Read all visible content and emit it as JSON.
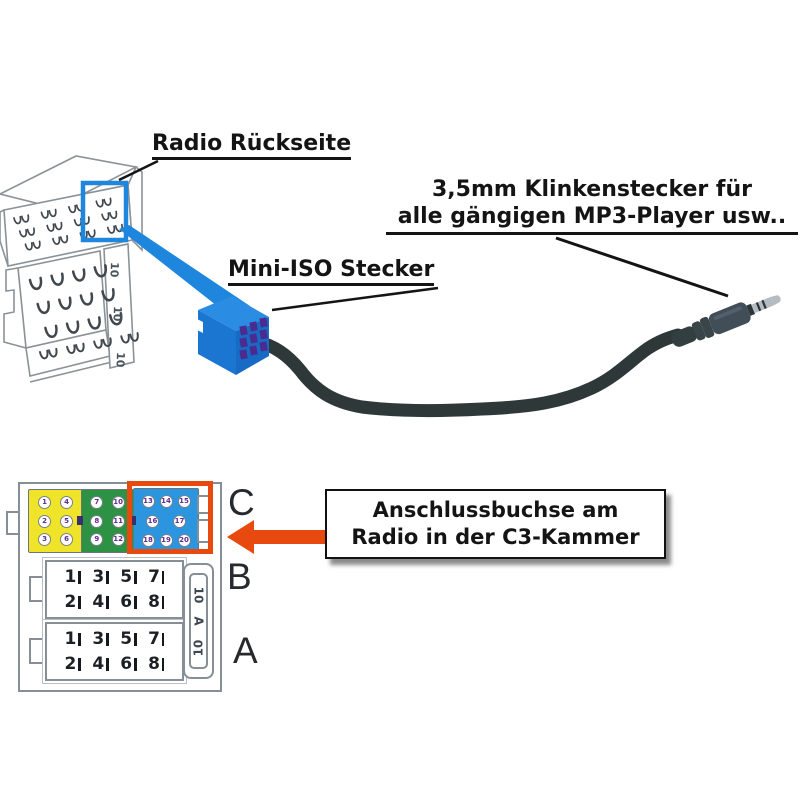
{
  "labels": {
    "radio_back": "Radio Rückseite",
    "mini_iso": "Mini-ISO Stecker",
    "jack_line1": "3,5mm Klinkenstecker für",
    "jack_line2": "alle gängigen MP3-Player usw.."
  },
  "callout": {
    "line1": "Anschlussbuchse am",
    "line2": "Radio in der C3-Kammer"
  },
  "iso_connector": {
    "row_letters": {
      "c": "C",
      "b": "B",
      "a": "A"
    },
    "c_sections": [
      {
        "name": "C1",
        "color": "#efe42a",
        "pin_rows": [
          [
            "1",
            "4"
          ],
          [
            "2",
            "5"
          ],
          [
            "3",
            "6"
          ]
        ]
      },
      {
        "name": "C2",
        "color": "#2e9245",
        "pin_rows": [
          [
            "7",
            "10"
          ],
          [
            "8",
            "11"
          ],
          [
            "9",
            "12"
          ]
        ]
      },
      {
        "name": "C3",
        "color": "#2b96df",
        "pin_rows": [
          [
            "13",
            "14",
            "15"
          ],
          [
            "16",
            "17"
          ],
          [
            "18",
            "19",
            "20"
          ]
        ]
      }
    ],
    "b_pins": [
      [
        "1",
        "3",
        "5",
        "7"
      ],
      [
        "2",
        "4",
        "6",
        "8"
      ]
    ],
    "a_pins": [
      [
        "1",
        "3",
        "5",
        "7"
      ],
      [
        "2",
        "4",
        "6",
        "8"
      ]
    ],
    "side_strip": [
      "10",
      "A",
      "10"
    ]
  },
  "radio_drawing": {
    "strip_labels": [
      "10",
      "10",
      "10"
    ]
  },
  "colors": {
    "highlight_blue": "#1e86dd",
    "connector_blue": "#1b76d2",
    "pin_purple": "#4b2b8f",
    "arrow_orange": "#e8490f",
    "cable_dark": "#2e3839"
  }
}
